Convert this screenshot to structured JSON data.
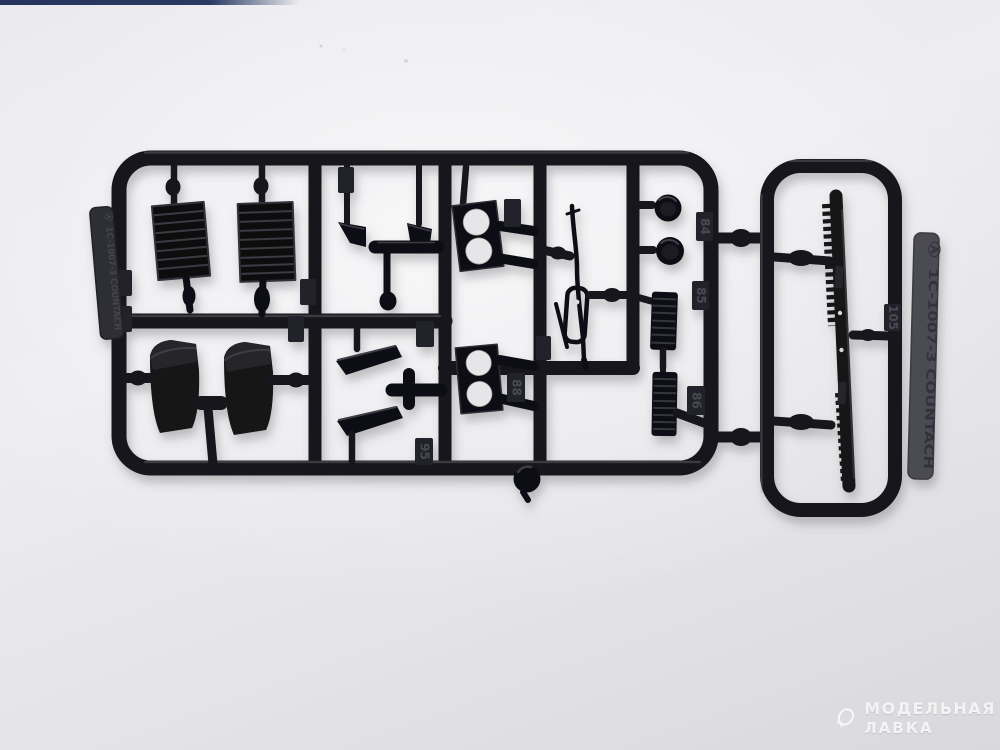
{
  "photo": {
    "background_color": "#e9e9ec",
    "top_strip_color": "#26345c",
    "plastic_color": "#18181c",
    "tab_light_color": "#4b4b53",
    "hole_color": "#e6e6e9"
  },
  "sprue": {
    "brand_logo_glyph": "Ⓐ",
    "brand_tab_text": "1C-1007-3 COUNTACH",
    "tags": {
      "t84": "84",
      "t85": "85",
      "t86": "86",
      "t88": "88",
      "t95": "95",
      "t105": "105"
    }
  },
  "watermark": {
    "line1": "МОДЕЛЬНАЯ",
    "line2": "ЛАВКА"
  }
}
